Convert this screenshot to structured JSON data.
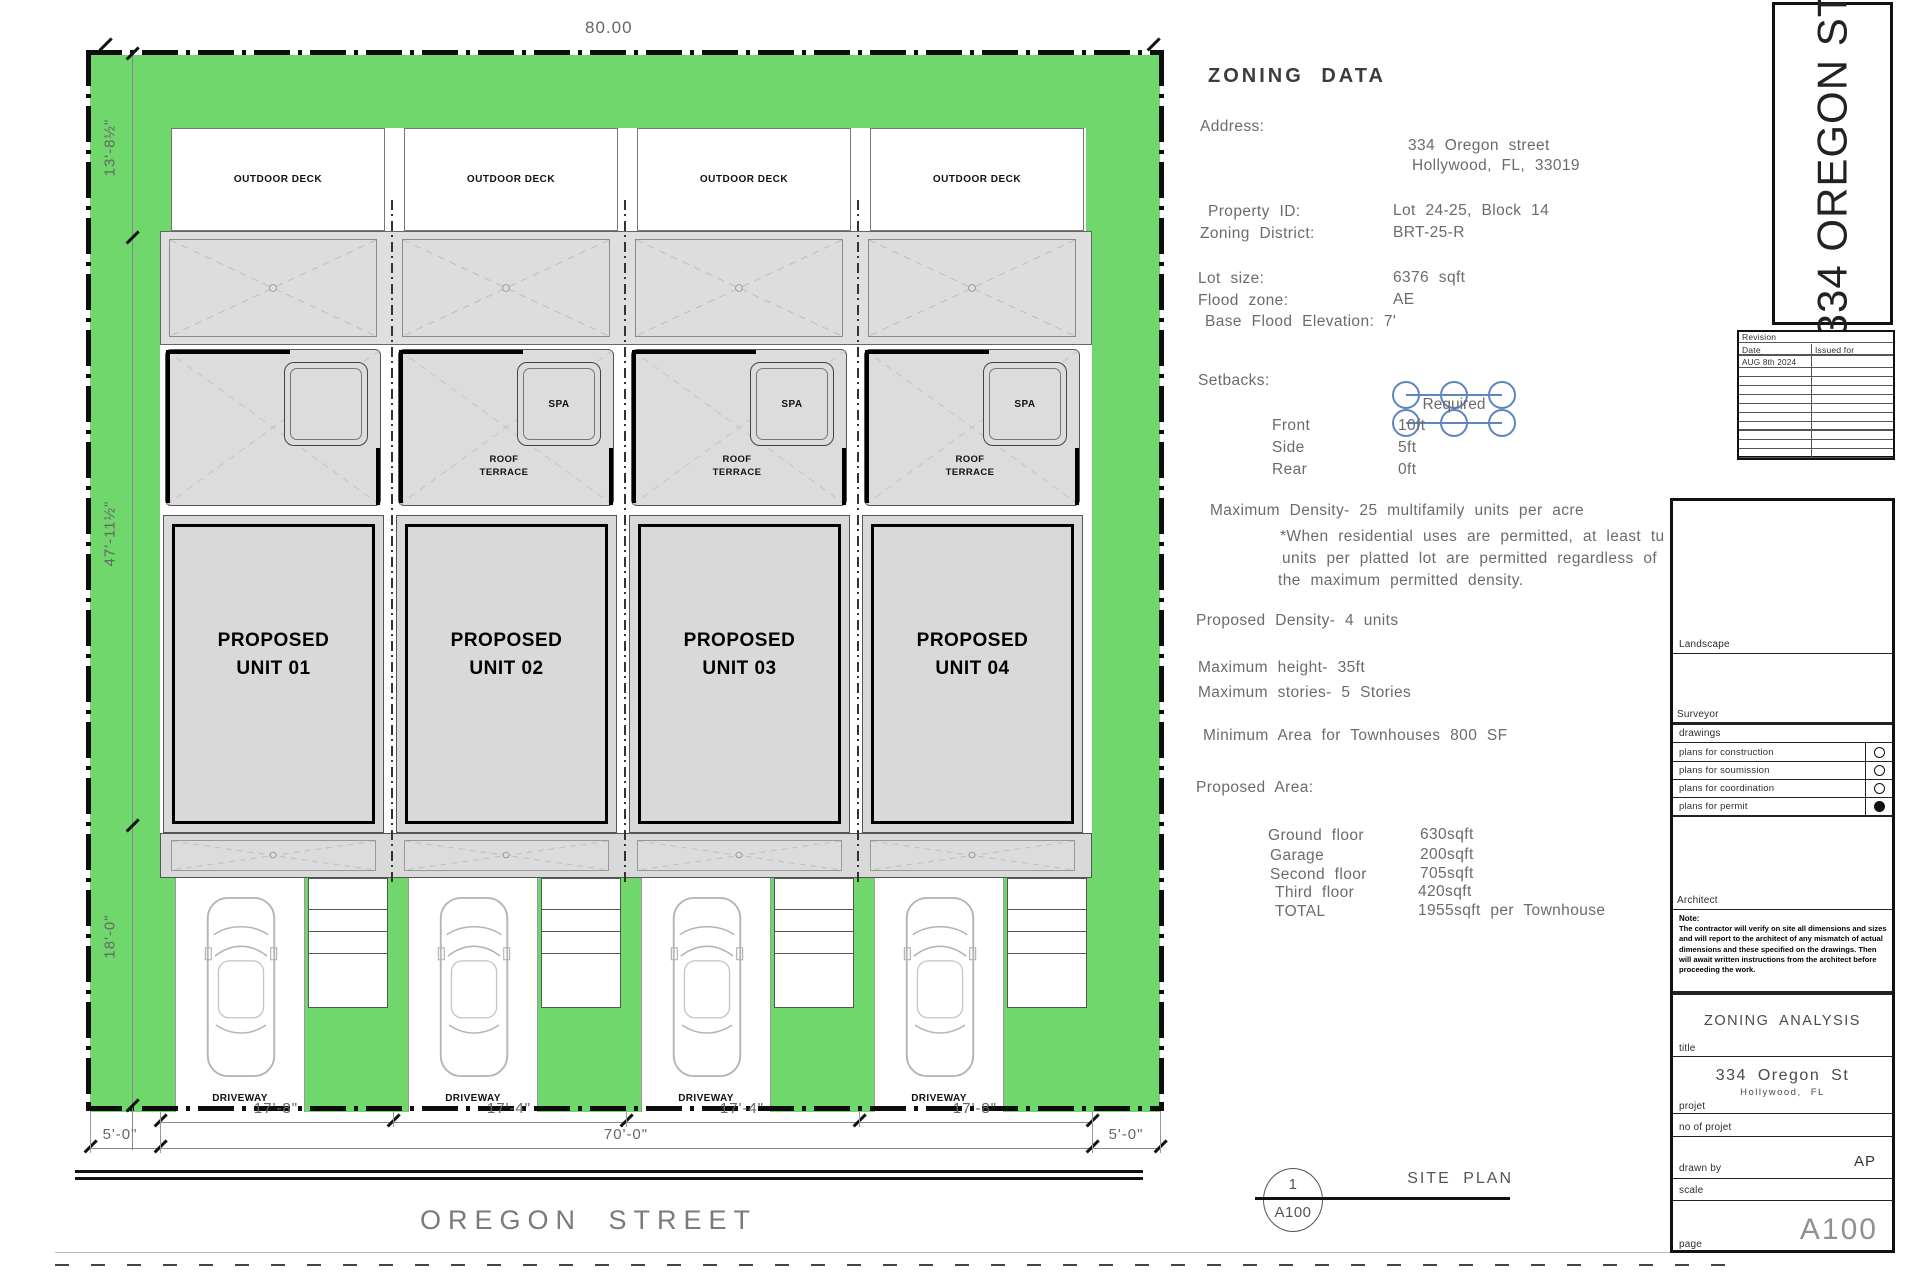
{
  "site_plan": {
    "dims": {
      "top_width": "80.00",
      "left_top": "13'-8½\"",
      "left_middle": "47'-11½\"",
      "left_bottom": "18'-0\"",
      "unit_widths": [
        "17'-8\"",
        "17'-4\"",
        "17'-4\"",
        "17'-8\""
      ],
      "setback_left": "5'-0\"",
      "frontage": "70'-0\"",
      "setback_right": "5'-0\""
    },
    "street_name": "OREGON STREET",
    "callout": {
      "number": "1",
      "sheet": "A100",
      "label": "SITE PLAN"
    },
    "units": [
      {
        "name": "PROPOSED\nUNIT 01",
        "deck_label": "OUTDOOR DECK",
        "driveway_label": "DRIVEWAY"
      },
      {
        "name": "PROPOSED\nUNIT 02",
        "deck_label": "OUTDOOR DECK",
        "terrace_label": "ROOF\nTERRACE",
        "spa_label": "SPA",
        "driveway_label": "DRIVEWAY"
      },
      {
        "name": "PROPOSED\nUNIT 03",
        "deck_label": "OUTDOOR DECK",
        "terrace_label": "ROOF\nTERRACE",
        "spa_label": "SPA",
        "driveway_label": "DRIVEWAY"
      },
      {
        "name": "PROPOSED\nUNIT 04",
        "deck_label": "OUTDOOR DECK",
        "terrace_label": "ROOF\nTERRACE",
        "spa_label": "SPA",
        "driveway_label": "DRIVEWAY"
      }
    ],
    "colors": {
      "lot_green": "#6fd76b",
      "building_gray": "#d9d9d9",
      "cloud_blue": "#5d85c0"
    }
  },
  "zoning": {
    "title": "ZONING DATA",
    "address_label": "Address:",
    "address_line1": "334 Oregon street",
    "address_line2": "Hollywood, FL, 33019",
    "property_id_label": "Property ID:",
    "property_id": "Lot 24-25, Block 14",
    "zoning_district_label": "Zoning District:",
    "zoning_district": "BRT-25-R",
    "lot_size_label": "Lot size:",
    "lot_size": "6376 sqft",
    "flood_zone_label": "Flood zone:",
    "flood_zone": "AE",
    "base_flood": "Base Flood Elevation: 7'",
    "setbacks_label": "Setbacks:",
    "required_label": "Required",
    "setbacks": [
      {
        "label": "Front",
        "value": "10ft"
      },
      {
        "label": "Side",
        "value": "5ft"
      },
      {
        "label": "Rear",
        "value": "0ft"
      }
    ],
    "max_density": "Maximum Density- 25 multifamily units per acre",
    "density_note_line1": "*When residential uses are permitted, at least tu",
    "density_note_line2": "units per platted lot are permitted regardless of",
    "density_note_line3": "the maximum permitted density.",
    "proposed_density": "Proposed Density- 4 units",
    "max_height": "Maximum height- 35ft",
    "max_stories": "Maximum stories- 5 Stories",
    "min_area": "Minimum Area for Townhouses 800 SF",
    "proposed_area_label": "Proposed Area:",
    "areas": [
      {
        "label": "Ground floor",
        "value": "630sqft"
      },
      {
        "label": "Garage",
        "value": "200sqft"
      },
      {
        "label": "Second floor",
        "value": "705sqft"
      },
      {
        "label": "Third floor",
        "value": "420sqft"
      },
      {
        "label": "TOTAL",
        "value": "1955sqft per Townhouse"
      }
    ]
  },
  "titleblock": {
    "project_vertical": "334 OREGON ST",
    "revision": {
      "header": "Revision",
      "date_col": "Date",
      "issued_col": "Issued for",
      "first_row_date": "AUG 8th 2024"
    },
    "landscape_label": "Landscape",
    "surveyor_label": "Surveyor",
    "drawings_label": "drawings",
    "plan_rows": [
      {
        "label": "plans for construction",
        "selected": false
      },
      {
        "label": "plans for soumission",
        "selected": false
      },
      {
        "label": "plans for coordination",
        "selected": false
      },
      {
        "label": "plans for permit",
        "selected": true
      }
    ],
    "architect_label": "Architect",
    "note_label": "Note:",
    "note_text": "The contractor will verify on site all dimensions and sizes and will report to the architect of any mismatch of actual dimensions and these specified on the drawings. Then will await written instructions from the architect before proceeding the work.",
    "analysis_title": "ZONING  ANALYSIS",
    "title_label": "title",
    "project_title": "334 Oregon St",
    "project_subtitle": "Hollywood, FL",
    "projet_label": "projet",
    "no_projet_label": "no of projet",
    "drawn_by_label": "drawn by",
    "drawn_by": "AP",
    "scale_label": "scale",
    "sheet_number": "A100",
    "page_label": "page"
  }
}
